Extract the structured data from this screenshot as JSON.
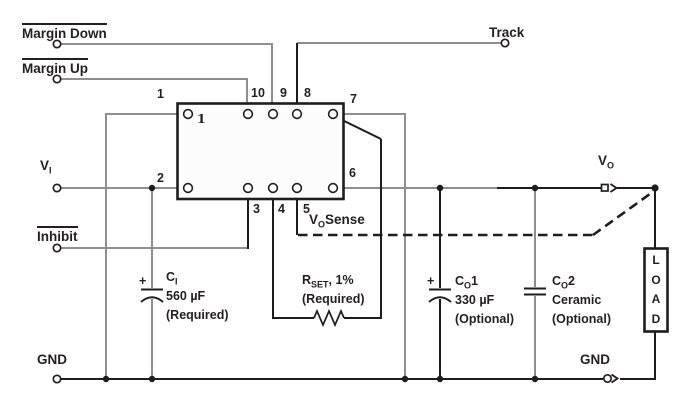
{
  "colors": {
    "wire_gray": "#8f8f8f",
    "wire_black": "#1d1d1d",
    "text": "#231f20",
    "module_fill": "#fcfcfc"
  },
  "labels": {
    "margin_down": "Margin Down",
    "margin_up": "Margin Up",
    "track": "Track",
    "inhibit": "Inhibit",
    "gnd_left": "GND",
    "gnd_right": "GND",
    "vi": {
      "base": "V",
      "sub": "I"
    },
    "vo": {
      "base": "V",
      "sub": "O"
    },
    "vo_sense": {
      "base": "V",
      "sub": "O",
      "rest": "Sense"
    }
  },
  "module": {
    "pin_numbers": {
      "p1": "1",
      "p2": "2",
      "p3": "3",
      "p4": "4",
      "p5": "5",
      "p6": "6",
      "p7": "7",
      "p8": "8",
      "p9": "9",
      "p10": "10"
    },
    "pin1_inner_mark": "1"
  },
  "components": {
    "ci": {
      "name": {
        "base": "C",
        "sub": "I"
      },
      "polarity": "+",
      "value": "560 µF",
      "note": "(Required)"
    },
    "rset": {
      "name": {
        "base": "R",
        "sub": "SET"
      },
      "suffix": ", 1%",
      "note": "(Required)"
    },
    "co1": {
      "name": {
        "base": "C",
        "sub": "O"
      },
      "index": "1",
      "polarity": "+",
      "value": "330 µF",
      "note": "(Optional)"
    },
    "co2": {
      "name": {
        "base": "C",
        "sub": "O"
      },
      "index": "2",
      "value": "Ceramic",
      "note": "(Optional)"
    },
    "load": {
      "letters": [
        "L",
        "O",
        "A",
        "D"
      ]
    }
  }
}
